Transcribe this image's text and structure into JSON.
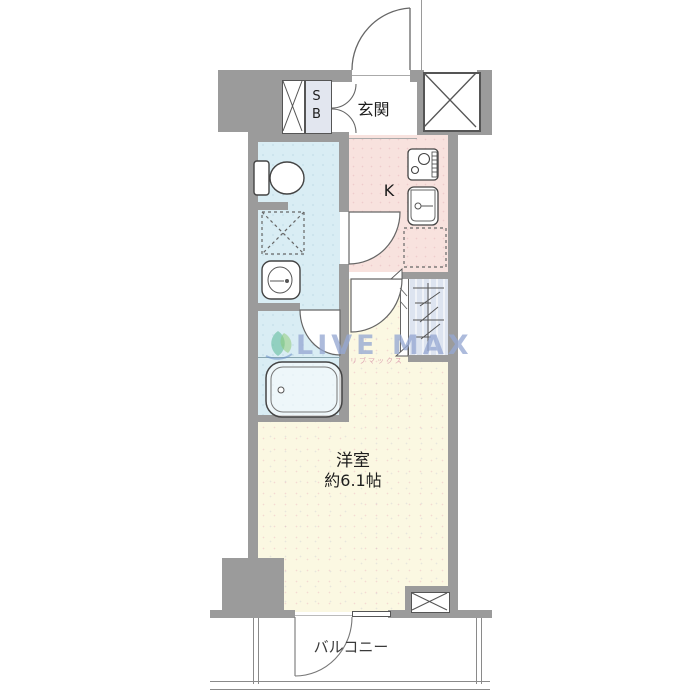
{
  "plan": {
    "type": "apartment-floor-plan",
    "rooms": {
      "entrance": "玄関",
      "shoe_box": "SB",
      "kitchen": "K",
      "main_room": "洋室",
      "main_room_size": "約6.1帖",
      "balcony": "バルコニー"
    },
    "watermark": {
      "text": "LIVE MAX",
      "subtext": "リブマックス"
    },
    "colors": {
      "wall": "#9b9b9b",
      "wet_area_floor": "#d9edf4",
      "kitchen_floor": "#f8e2de",
      "main_room_floor": "#fbf8e2",
      "closet": "#dde4f0",
      "shoe_box_fill": "#e2e6ef",
      "watermark_text": "#96a8d2",
      "logo_green": "#57b896",
      "logo_lightgreen": "#8cc96f"
    },
    "fixture_icons": [
      "toilet-icon",
      "washing-machine-space-icon",
      "washbasin-icon",
      "bathtub-icon",
      "stove-icon",
      "kitchen-sink-icon",
      "refrigerator-space-icon",
      "closet-hanger-icon",
      "pipe-space-x-icon",
      "elevator-shaft-x-icon",
      "door-swing-icon"
    ]
  }
}
